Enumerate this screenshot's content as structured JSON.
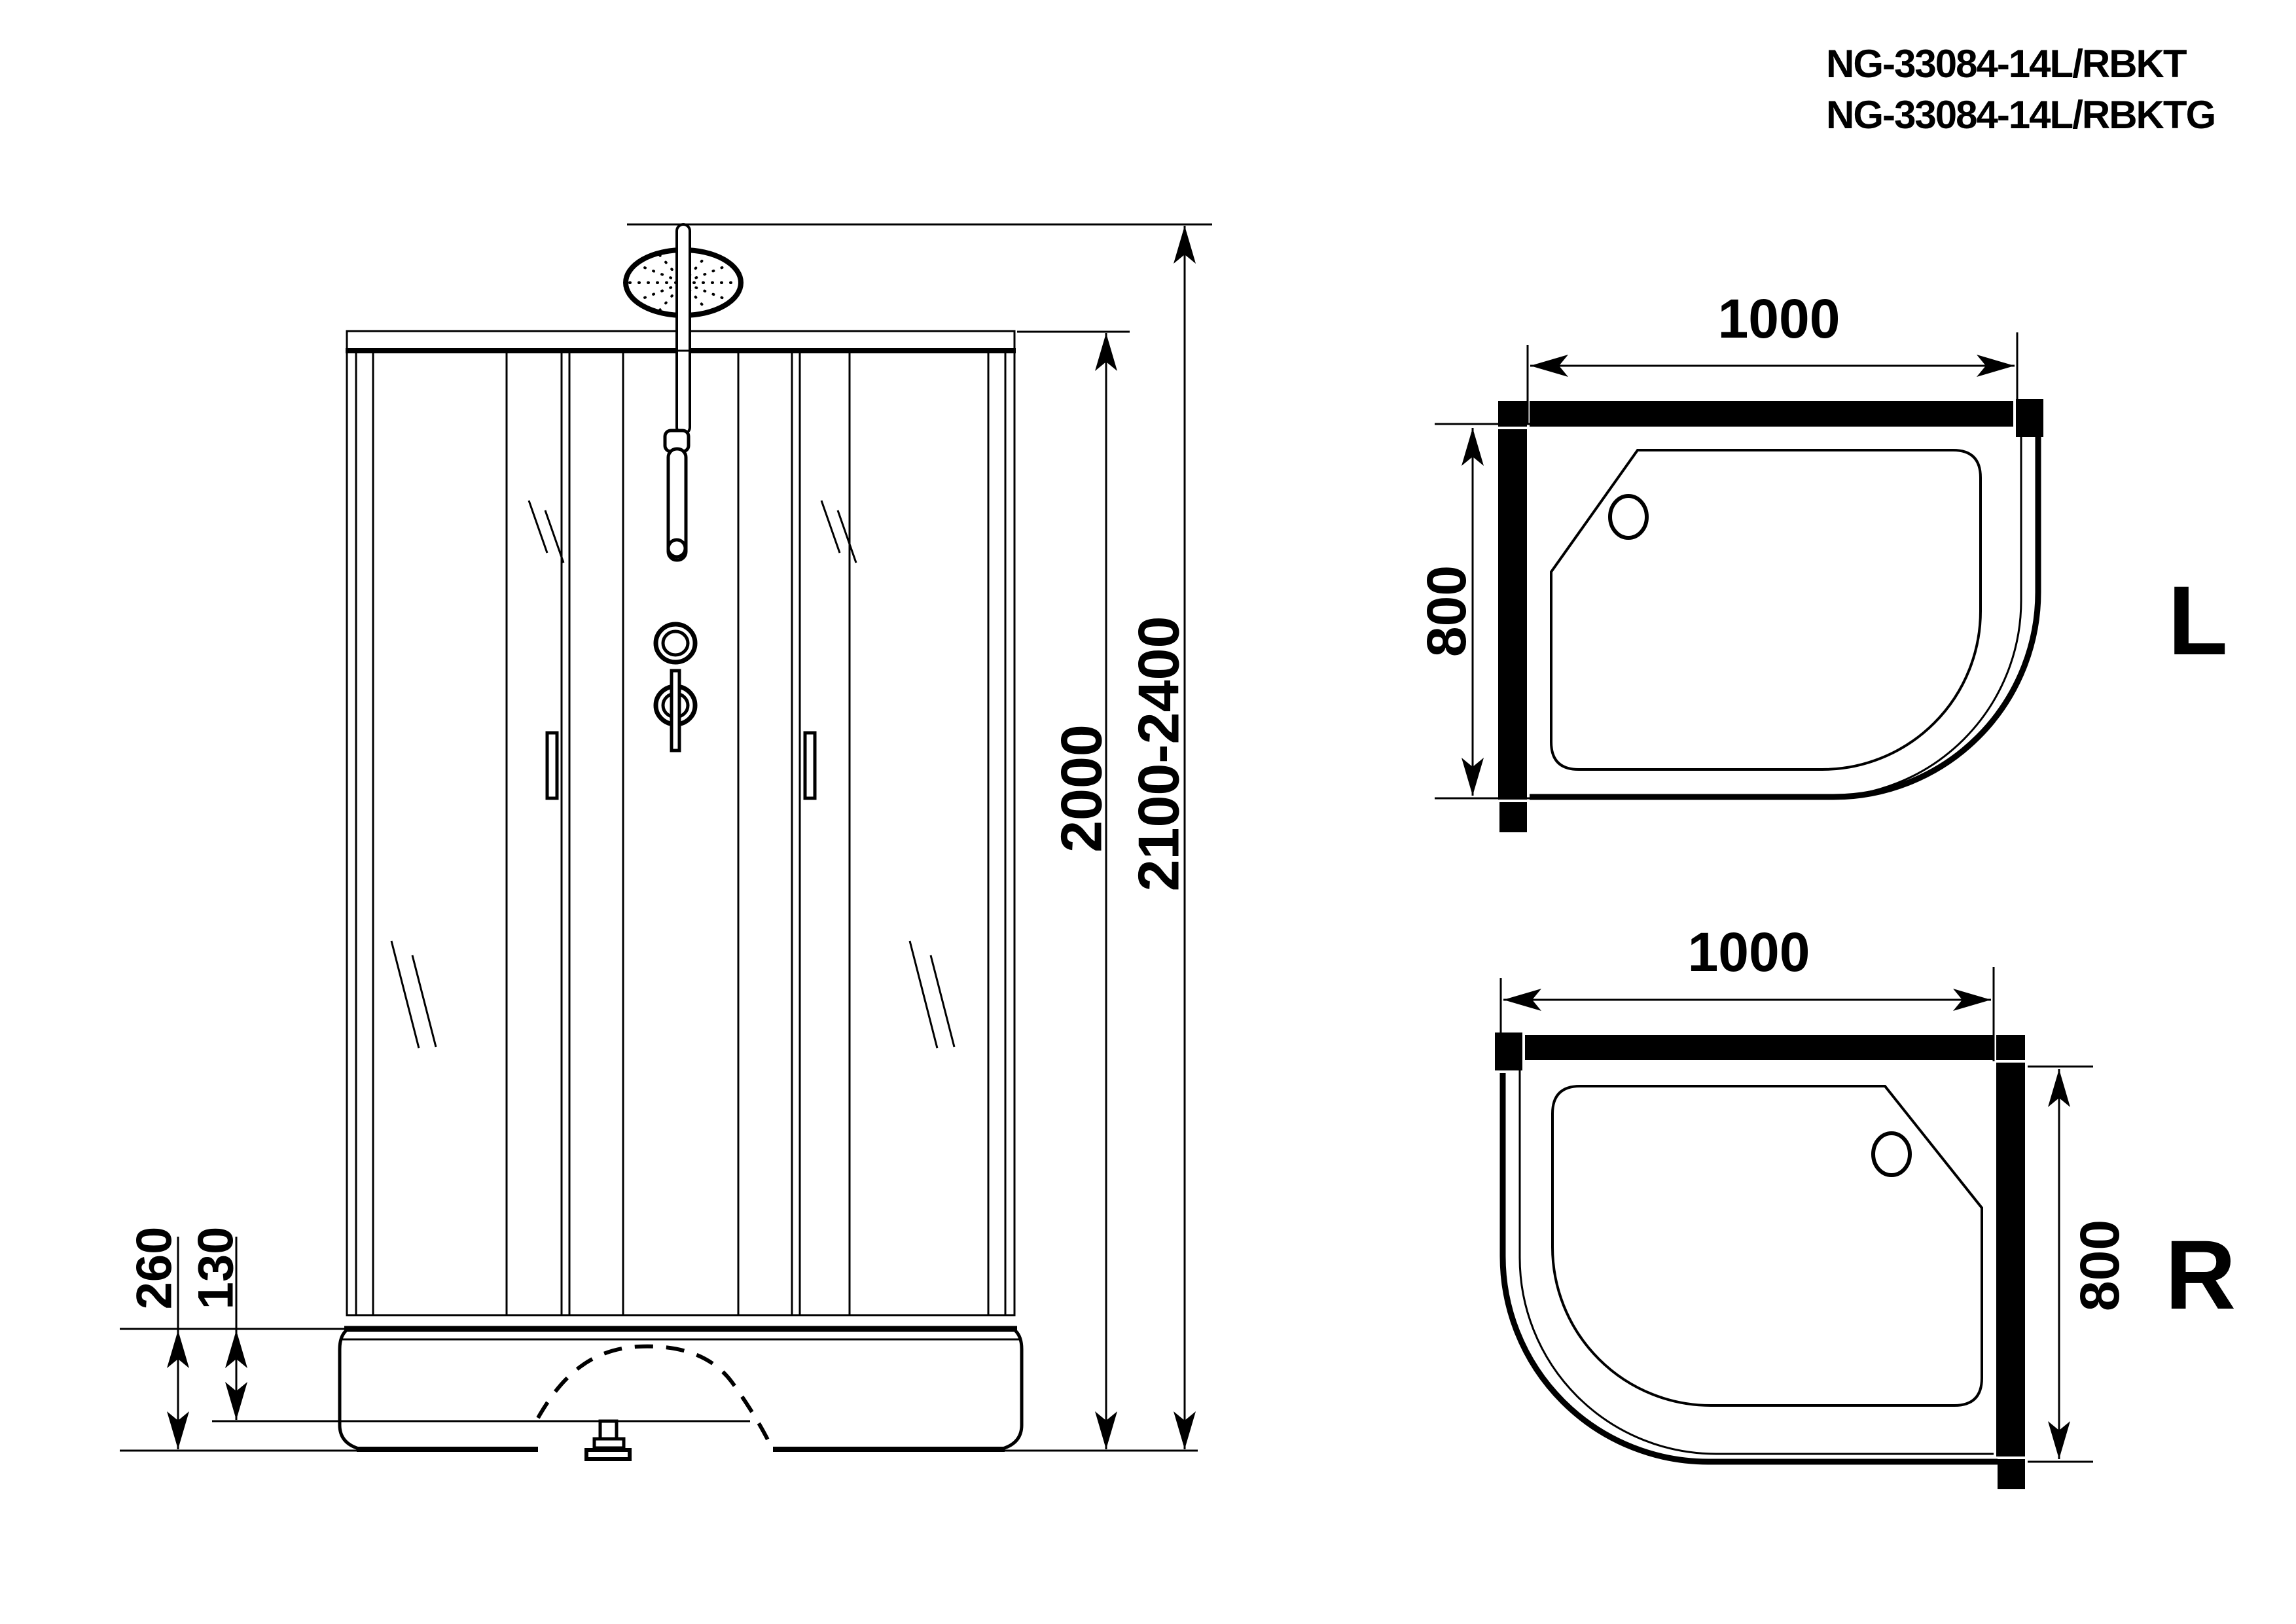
{
  "title": {
    "line1": "NG-33084-14L/RBKT",
    "line2": "NG-33084-14L/RBKTG"
  },
  "front_view": {
    "dim_inner_height": "2000",
    "dim_overall_height": "2100-2400",
    "dim_tray_height": "260",
    "dim_tray_step": "130"
  },
  "plan_left": {
    "dim_width": "1000",
    "dim_depth": "800",
    "label": "L"
  },
  "plan_right": {
    "dim_width": "1000",
    "dim_depth": "800",
    "label": "R"
  },
  "colors": {
    "ink": "#000000",
    "paper": "#ffffff"
  }
}
